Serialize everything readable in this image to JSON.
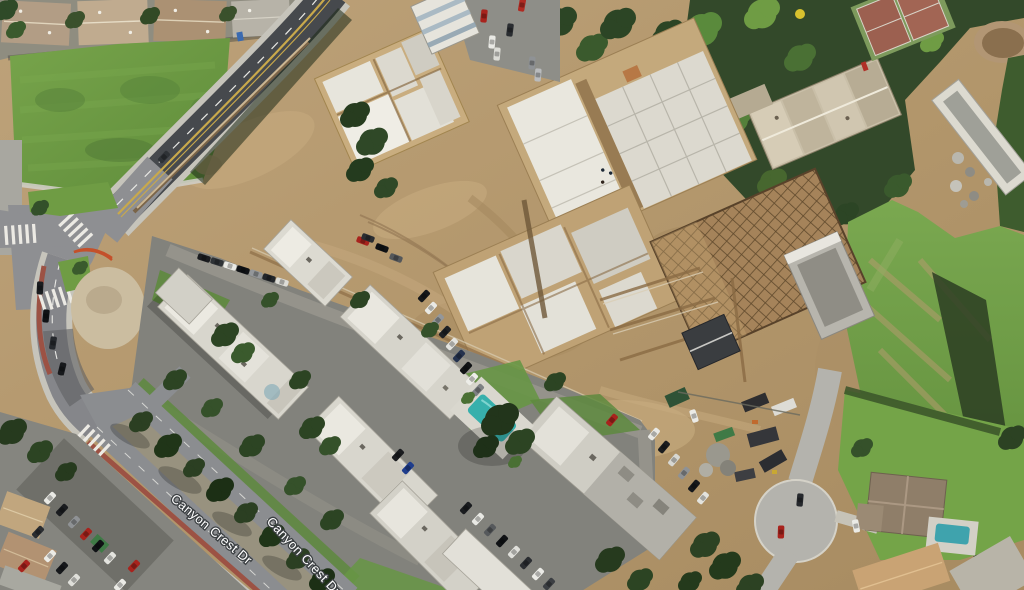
{
  "map": {
    "view_type": "satellite-aerial",
    "street_labels": [
      {
        "name": "canyon-crest-dr-label-1",
        "text": "Canyon Crest Dr",
        "x": 170,
        "y": 500,
        "rotation_deg": 40
      },
      {
        "name": "canyon-crest-dr-label-2",
        "text": "Canyon Crest Dr",
        "x": 266,
        "y": 522,
        "rotation_deg": 47
      }
    ],
    "landmarks": [
      "construction-site",
      "concrete-foundation-pads",
      "podium-formwork-grid",
      "apartment-complex",
      "swimming-pool",
      "tennis-court",
      "grass-field",
      "residential-rooftops",
      "divided-street-median",
      "road-intersection",
      "cul-de-sac",
      "equipment-yard",
      "tree-groves",
      "hillside-slope"
    ],
    "palette": {
      "dirt": "#b3976c",
      "grass_field": "#6f9c44",
      "hill_grass": "#74a448",
      "asphalt_dark": "#46494d",
      "asphalt_light": "#8e8f92",
      "parking_lot": "#82827c",
      "concrete_pad": "#e6e4db",
      "apartment_roof": "#d8d6cd",
      "house_roof_tan": "#b4a08a",
      "tree_green": "#2c4323",
      "pool_teal": "#37b0ac",
      "bike_lane_red": "#9c5244",
      "center_line_yellow": "#c9a94b",
      "label_fill": "#ffffff",
      "label_halo": "#3c4043"
    }
  }
}
